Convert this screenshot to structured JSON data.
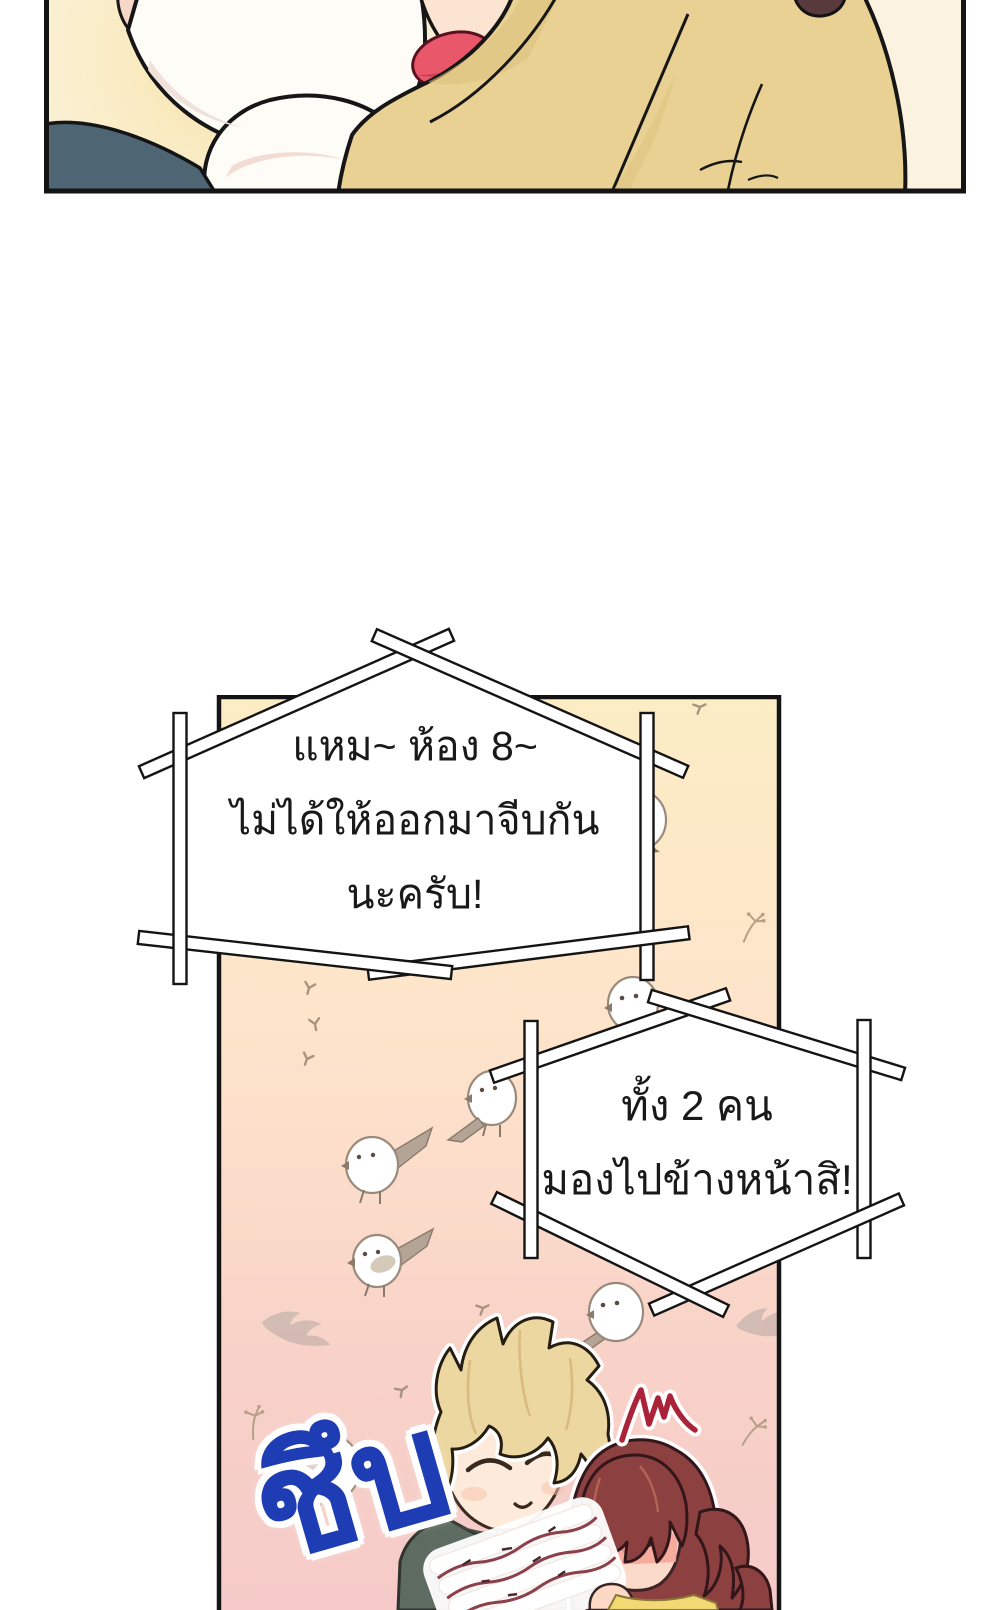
{
  "page": {
    "background": "#ffffff",
    "kind": "webtoon-comic-page"
  },
  "panel1": {
    "description": "cropped close-up panel of a person in a yellow sweater",
    "colors": {
      "background": "#fbf3e0",
      "glow": "#f7e2a4",
      "garment": "#e9d193",
      "fabric": "#fdfcf7",
      "skin": "#fce4d2",
      "mouth": "#e9576b",
      "teal_hair": "#4e6673",
      "brown_hair": "#583a3c",
      "border": "#141414"
    }
  },
  "panel2": {
    "description": "tall panel: blonde boy and blushing girl with small white birds",
    "bird_count": 7,
    "colors": {
      "border": "#141414",
      "bg_top": "#fcedc5",
      "bg_mid": "#fde2cb",
      "bg_bottom": "#f5cac8",
      "bird": "#ffffff",
      "boy_hair": "#ecd7a1",
      "boy_shirt": "#5d6b60",
      "girl_hair": "#8c403f",
      "girl_shirt": "#f2d974",
      "blush": "#f4a295",
      "surprise_mark": "#ab2338"
    }
  },
  "speech": {
    "bubble1": {
      "lines": [
        "แหม~ ห้อง 8~",
        "ไม่ได้ให้ออกมาจีบกัน",
        "นะครับ!"
      ]
    },
    "bubble2": {
      "lines": [
        "ทั้ง 2 คน",
        "มองไปข้างหน้าสิ!"
      ]
    }
  },
  "sfx": {
    "text": "ชึบ",
    "color": "#1e3db4"
  }
}
